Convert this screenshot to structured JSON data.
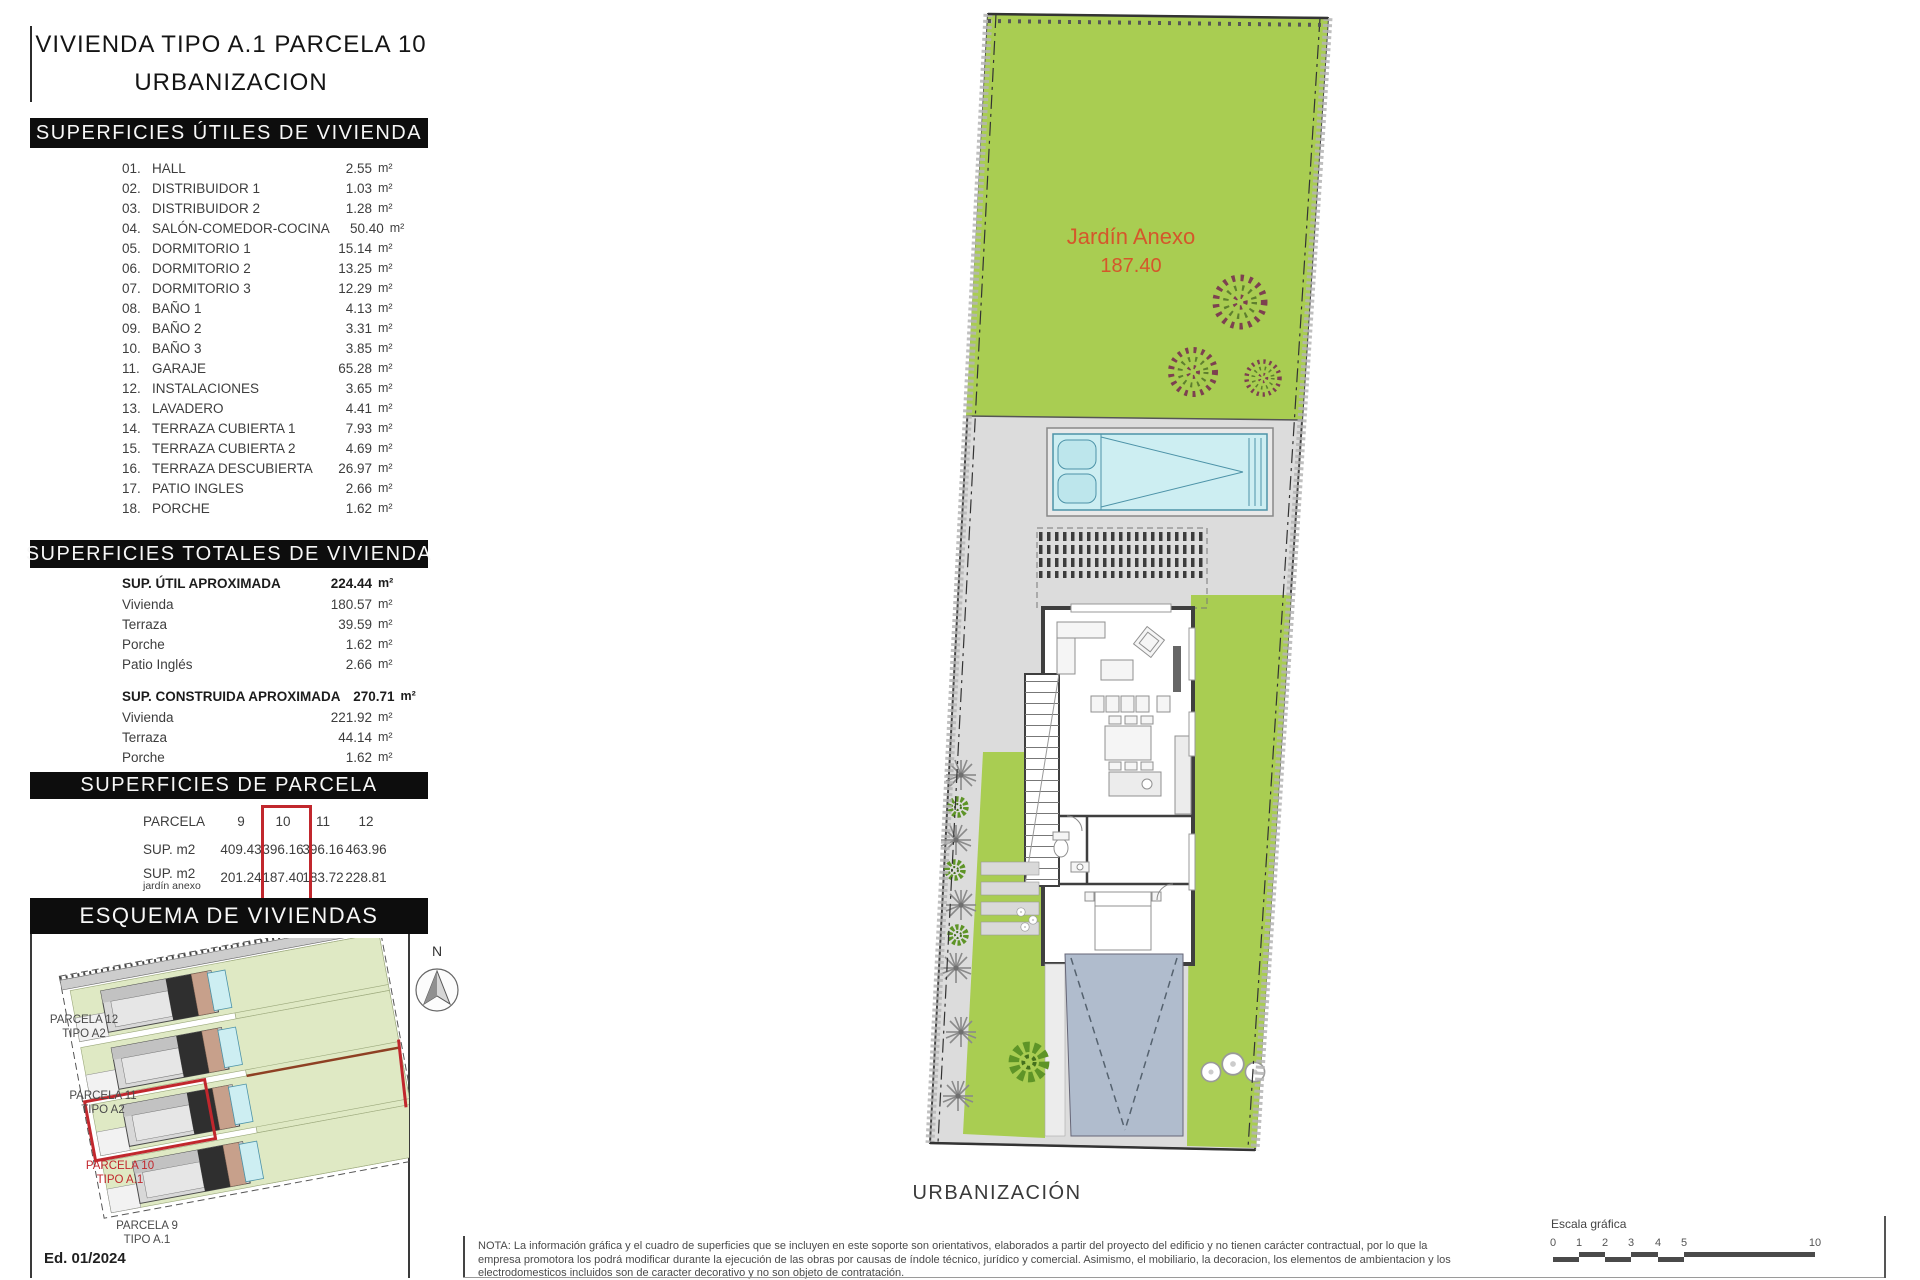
{
  "title": {
    "line1": "VIVIENDA TIPO A.1 PARCELA 10",
    "line2": "URBANIZACION"
  },
  "sections": {
    "utiles": {
      "header": "SUPERFICIES ÚTILES DE VIVIENDA",
      "unit": "m²",
      "rows": [
        {
          "num": "01.",
          "name": "HALL",
          "value": "2.55"
        },
        {
          "num": "02.",
          "name": "DISTRIBUIDOR 1",
          "value": "1.03"
        },
        {
          "num": "03.",
          "name": "DISTRIBUIDOR 2",
          "value": "1.28"
        },
        {
          "num": "04.",
          "name": "SALÓN-COMEDOR-COCINA",
          "value": "50.40"
        },
        {
          "num": "05.",
          "name": "DORMITORIO 1",
          "value": "15.14"
        },
        {
          "num": "06.",
          "name": "DORMITORIO 2",
          "value": "13.25"
        },
        {
          "num": "07.",
          "name": "DORMITORIO 3",
          "value": "12.29"
        },
        {
          "num": "08.",
          "name": "BAÑO 1",
          "value": "4.13"
        },
        {
          "num": "09.",
          "name": "BAÑO 2",
          "value": "3.31"
        },
        {
          "num": "10.",
          "name": "BAÑO 3",
          "value": "3.85"
        },
        {
          "num": "11.",
          "name": "GARAJE",
          "value": "65.28"
        },
        {
          "num": "12.",
          "name": "INSTALACIONES",
          "value": "3.65"
        },
        {
          "num": "13.",
          "name": "LAVADERO",
          "value": "4.41"
        },
        {
          "num": "14.",
          "name": "TERRAZA CUBIERTA 1",
          "value": "7.93"
        },
        {
          "num": "15.",
          "name": "TERRAZA CUBIERTA 2",
          "value": "4.69"
        },
        {
          "num": "16.",
          "name": "TERRAZA DESCUBIERTA",
          "value": "26.97"
        },
        {
          "num": "17.",
          "name": "PATIO INGLES",
          "value": "2.66"
        },
        {
          "num": "18.",
          "name": "PORCHE",
          "value": "1.62"
        }
      ]
    },
    "totales": {
      "header": "SUPERFICIES TOTALES DE VIVIENDA",
      "unit": "m²",
      "groups": [
        {
          "label": "SUP. ÚTIL APROXIMADA",
          "value": "224.44",
          "items": [
            [
              "Vivienda",
              "180.57"
            ],
            [
              "Terraza",
              "39.59"
            ],
            [
              "Porche",
              "1.62"
            ],
            [
              "Patio Inglés",
              "2.66"
            ]
          ]
        },
        {
          "label": "SUP. CONSTRUIDA APROXIMADA",
          "value": "270.71",
          "items": [
            [
              "Vivienda",
              "221.92"
            ],
            [
              "Terraza",
              "44.14"
            ],
            [
              "Porche",
              "1.62"
            ],
            [
              "Patio inglés",
              "3.03"
            ]
          ]
        }
      ]
    },
    "parcela": {
      "header": "SUPERFICIES DE PARCELA",
      "row_label": "PARCELA",
      "col_headers": [
        "9",
        "10",
        "11",
        "12"
      ],
      "rows": [
        {
          "label": "SUP. m2",
          "sub": "",
          "values": [
            "409.43",
            "396.16",
            "396.16",
            "463.96"
          ]
        },
        {
          "label": "SUP. m2",
          "sub": "jardín anexo",
          "values": [
            "201.24",
            "187.40",
            "183.72",
            "228.81"
          ]
        }
      ],
      "highlighted_column": "10"
    },
    "esquema": {
      "header": "ESQUEMA DE VIVIENDAS",
      "labels": [
        {
          "text1": "PARCELA 12",
          "text2": "TIPO A2"
        },
        {
          "text1": "PARCELA 11",
          "text2": "TIPO A2"
        },
        {
          "text1": "PARCELA 10",
          "text2": "TIPO A.1"
        },
        {
          "text1": "PARCELA 9",
          "text2": "TIPO A.1"
        }
      ],
      "north_label": "N",
      "edition": "Ed. 01/2024"
    }
  },
  "plan": {
    "garden_label": "Jardín Anexo",
    "garden_value": "187.40",
    "caption": "URBANIZACIÓN"
  },
  "footer": {
    "nota_lines": [
      "NOTA: La información gráfica y el cuadro de superficies que se incluyen en este soporte son orientativos, elaborados a partir del proyecto del edificio y no tienen carácter contractual, por lo que la",
      "empresa promotora los podrá modificar durante la ejecución de las obras por causas de índole técnico, jurídico y comercial. Asimismo, el mobiliario, la decoracion, los elementos de ambientacion y los",
      "electrodomesticos incluidos son de caracter decorativo y no son objeto de contratación."
    ],
    "scale_label": "Escala gráfica",
    "scale_ticks": [
      "0",
      "1",
      "2",
      "3",
      "4",
      "5",
      "10"
    ]
  },
  "colors": {
    "garden_green": "#a9cd52",
    "pale_green": "#dfe9c4",
    "pool_fill": "#cdeef2",
    "pool_border": "#4d93a8",
    "terrace_gray": "#dcdcdc",
    "wall_dark": "#3f3f3f",
    "driveway_slate": "#b0bccd",
    "highlight_red": "#c1272d",
    "garden_text_orange": "#d4572b",
    "header_bar": "#0d0d0d"
  }
}
